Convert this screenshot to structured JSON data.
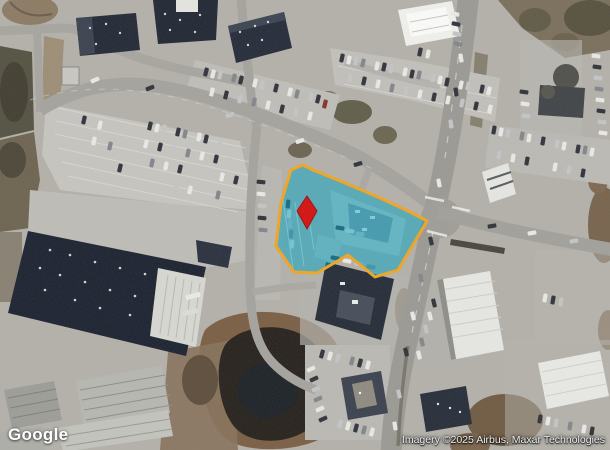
{
  "map": {
    "logo_text": "Google",
    "attribution_text": "Imagery ©2025 Airbus, Maxar Technologies"
  },
  "parcel": {
    "fill_color": "#00a2c3",
    "border_color": "#f2a51e",
    "pin_color": "#d60e0e"
  }
}
